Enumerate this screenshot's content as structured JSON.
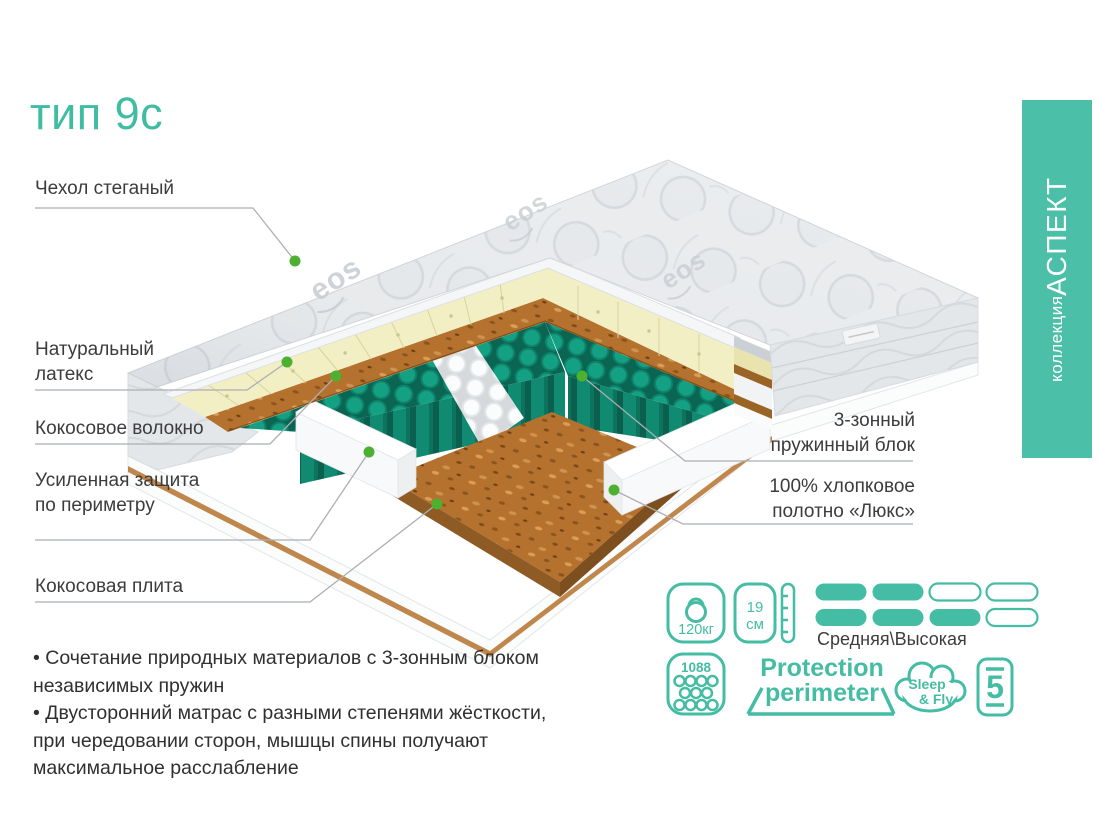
{
  "title": "тип 9с",
  "banner": {
    "prefix": "коллекция ",
    "name": "АСПЕКТ"
  },
  "illustration": {
    "brand_logo": "eos"
  },
  "callouts": {
    "left": [
      {
        "text": "Чехол стеганый"
      },
      {
        "text": "Натуральный\nлатекс"
      },
      {
        "text": "Кокосовое волокно"
      },
      {
        "text": "Усиленная защита\nпо периметру"
      },
      {
        "text": "Кокосовая плита"
      }
    ],
    "right": [
      {
        "text": "3-зонный\nпружинный блок"
      },
      {
        "text": "100% хлопковое\nполотно «Люкс»"
      }
    ]
  },
  "features": [
    "Сочетание природных материалов с 3-зонным блоком независимых пружин",
    "Двусторонний матрас с разными степенями жёсткости, при чередовании сторон, мышцы спины получают максимальное расслабление"
  ],
  "specs": {
    "max_weight": "120кг",
    "height": {
      "value": "19",
      "unit": "см"
    },
    "firmness": {
      "label": "Средняя\\Высокая",
      "rows": [
        [
          1,
          1,
          0,
          0
        ],
        [
          1,
          1,
          1,
          0
        ]
      ]
    },
    "springs_count": "1088",
    "protection": {
      "line1": "Protection",
      "line2": "perimeter"
    },
    "brand_cloud": {
      "line1": "Sleep",
      "line2": "& Fly"
    },
    "warranty_years": "5"
  },
  "colors": {
    "accent": "#45BCA4",
    "banner": "#4BBFA7",
    "title": "#3EBDA3",
    "spring_teal": "#14A183",
    "coconut": "#B5722E",
    "latex": "#F3EFC5",
    "callout_dot": "#4DB031"
  }
}
